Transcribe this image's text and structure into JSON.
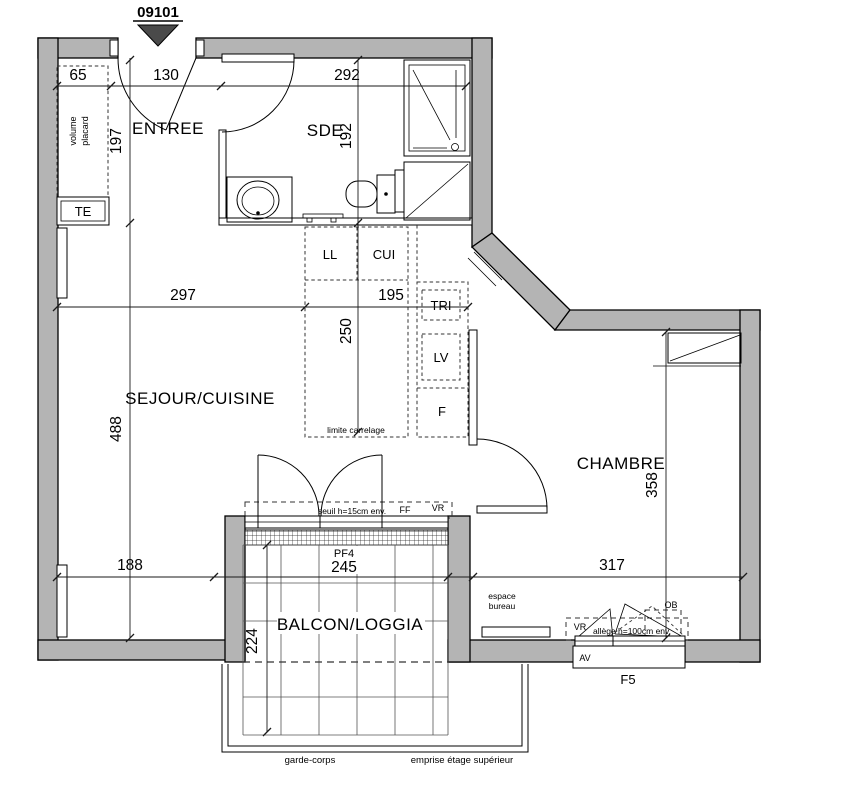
{
  "marker": {
    "unit": "09101"
  },
  "rooms": {
    "entree": "ENTREE",
    "sde": "SDE",
    "sejour": "SEJOUR/CUISINE",
    "chambre": "CHAMBRE",
    "balcon": "BALCON/LOGGIA"
  },
  "fixtures": {
    "volume": "volume",
    "placard": "placard",
    "te": "TE",
    "espace": "espace",
    "bureau": "bureau"
  },
  "kitchen": {
    "ll": "LL",
    "cui": "CUI",
    "tri": "TRI",
    "lv": "LV",
    "f": "F",
    "limite": "limite carrelage"
  },
  "windows": {
    "pf4": "PF4",
    "f5": "F5",
    "ff": "FF",
    "vr_sejour": "VR",
    "vr_chambre": "VR",
    "av": "AV",
    "ob": "OB",
    "seuil": "seuil h=15cm env.",
    "allege": "allège h=100cm env."
  },
  "balcony": {
    "garde_corps": "garde-corps",
    "emprise": "emprise étage supérieur"
  },
  "dimensions": {
    "top_left": "65",
    "top_entree": "130",
    "top_sde": "292",
    "entree_depth": "197",
    "sde_depth": "192",
    "sejour_width": "297",
    "kitchen_width": "195",
    "kitchen_depth": "250",
    "sejour_depth": "488",
    "chambre_depth": "358",
    "chambre_width": "317",
    "bottom_left": "188",
    "pf4_width": "245",
    "balcon_depth": "224"
  },
  "colors": {
    "wall_fill": "#b4b4b4",
    "marker_fill": "#4a4a4a",
    "line": "#000000",
    "dim_line": "#1a1a1a"
  }
}
